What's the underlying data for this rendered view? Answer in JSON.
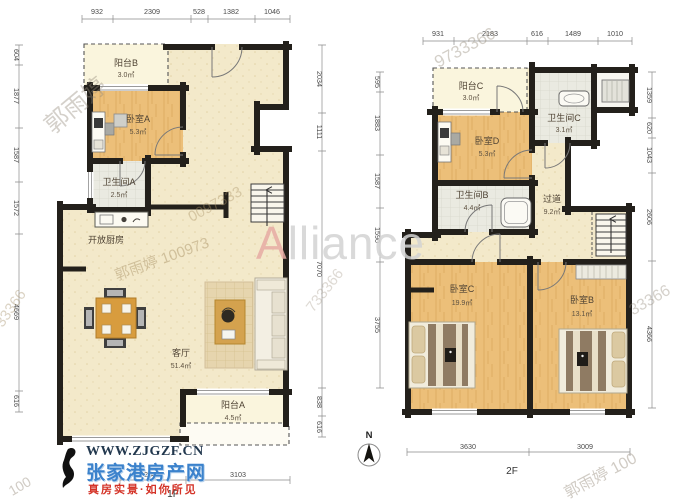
{
  "floorplan": {
    "unit": "㎡",
    "compass": {
      "label": "N"
    },
    "colors": {
      "wall": "#23201b",
      "wood_floor": "#ecbf79",
      "tile_floor": "#eaeae1",
      "cream_floor": "#f3e9ca",
      "balcony_floor": "#faf5dd"
    },
    "plans": [
      {
        "name": "1F",
        "rooms": {
          "balconyB": {
            "label": "阳台B",
            "area": "3.0㎡"
          },
          "bedroomA": {
            "label": "卧室A",
            "area": "5.3㎡"
          },
          "bathroomA": {
            "label": "卫生间A",
            "area": "2.5㎡"
          },
          "kitchen": {
            "label": "开放厨房"
          },
          "living": {
            "label": "客厅",
            "area": "51.4㎡"
          },
          "balconyA": {
            "label": "阳台A",
            "area": "4.5㎡"
          }
        },
        "dims": {
          "top": [
            "932",
            "2309",
            "528",
            "1382",
            "1046"
          ],
          "left": [
            "604",
            "1877",
            "1587",
            "1572",
            "4669",
            "616"
          ],
          "right": [
            "2034",
            "1111",
            "7070",
            "838",
            "616"
          ],
          "bottom": [
            "2542",
            "3103"
          ]
        }
      },
      {
        "name": "2F",
        "rooms": {
          "balconyC": {
            "label": "阳台C",
            "area": "3.0㎡"
          },
          "bathroomC": {
            "label": "卫生间C",
            "area": "3.1㎡"
          },
          "bedroomD": {
            "label": "卧室D",
            "area": "5.3㎡"
          },
          "bathroomB": {
            "label": "卫生间B",
            "area": "4.4㎡"
          },
          "hallway": {
            "label": "过道",
            "area": "9.2㎡"
          },
          "bedroomC": {
            "label": "卧室C",
            "area": "19.9㎡"
          },
          "bedroomB": {
            "label": "卧室B",
            "area": "13.1㎡"
          }
        },
        "dims": {
          "top": [
            "931",
            "2183",
            "616",
            "1489",
            "1010"
          ],
          "left": [
            "595",
            "1883",
            "1587",
            "1590",
            "3755"
          ],
          "right": [
            "1359",
            "620",
            "1043",
            "2606",
            "4366"
          ],
          "bottom": [
            "3630",
            "3009"
          ]
        }
      }
    ]
  },
  "branding": {
    "website": "WWW.ZJGZF.CN",
    "site_name": "张家港房产网",
    "slogan": "真房实景·如你所见",
    "colors": {
      "site_blue": "#3b82cc",
      "slogan_red": "#d43327",
      "website_navy": "#22384e"
    }
  },
  "watermarks": {
    "alliance": {
      "first": "A",
      "rest": "lliance"
    },
    "items": [
      {
        "text": "郭雨婷"
      },
      {
        "text": "郭雨婷 100973"
      },
      {
        "text": "9733366"
      },
      {
        "text": "733366"
      },
      {
        "text": "33366"
      },
      {
        "text": "郭雨婷 100"
      },
      {
        "text": "100"
      },
      {
        "text": "33366"
      },
      {
        "text": "0097333"
      }
    ]
  }
}
